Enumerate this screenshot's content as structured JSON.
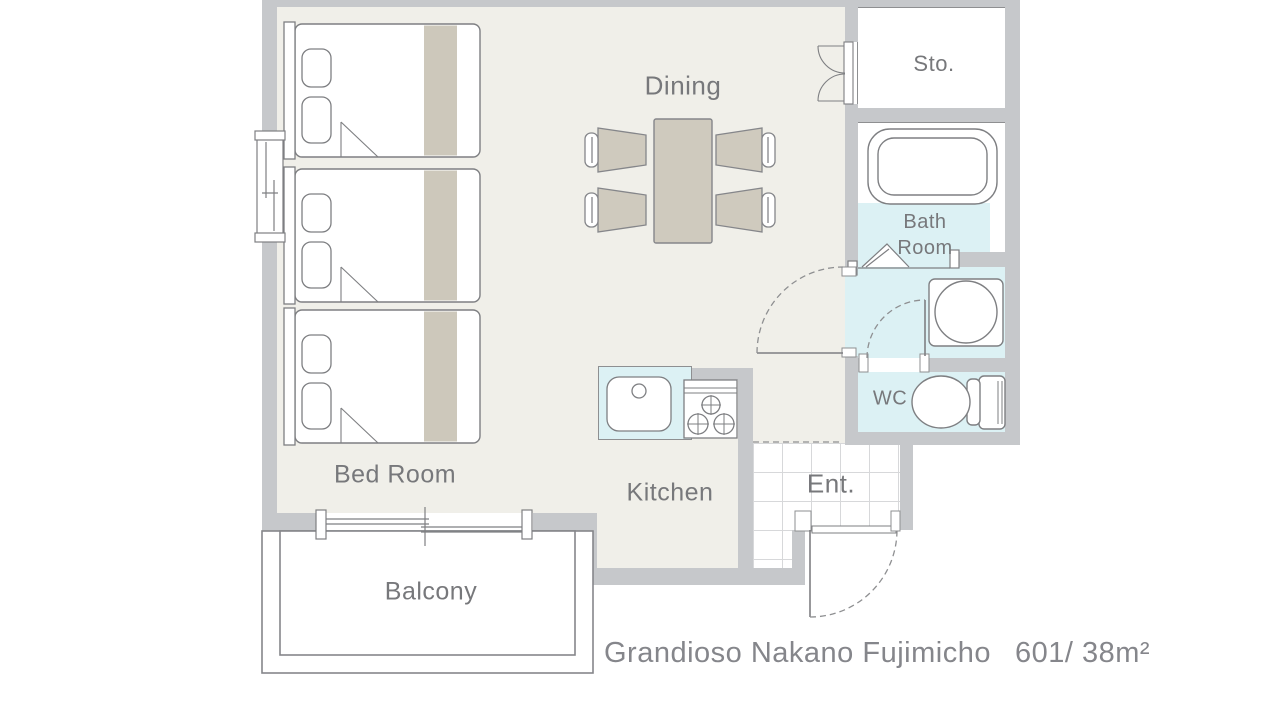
{
  "floorplan": {
    "rooms": {
      "dining": "Dining",
      "bed_room": "Bed Room",
      "kitchen": "Kitchen",
      "balcony": "Balcony",
      "entrance": "Ent.",
      "storage": "Sto.",
      "bath_line1": "Bath",
      "bath_line2": "Room",
      "wc": "WC"
    },
    "footer": {
      "building": "Grandioso Nakano Fujimicho",
      "unit": "601/ 38m²"
    },
    "fixtures": [
      "single-bed-icon x3",
      "pillow-icon x2 per bed",
      "dining-table-icon",
      "dining-chair-icon x4",
      "kitchen-sink-icon",
      "stove-3-burner-icon",
      "bathtub-icon",
      "washing-machine-icon",
      "toilet-icon",
      "double-swing-door-icon",
      "hinged-door-swing-icon x3",
      "folding-bath-door-icon",
      "sliding-window-icon x2",
      "tile-floor-entrance"
    ],
    "colors": {
      "wall": "#c6c8cb",
      "floor": "#f0efe9",
      "wet_floor": "#dcf1f4",
      "furniture": "#cfcabe",
      "outline": "#7e7f82",
      "label_text": "#77787b",
      "title_text": "#85868b",
      "tile_line": "#d7d8da"
    }
  }
}
